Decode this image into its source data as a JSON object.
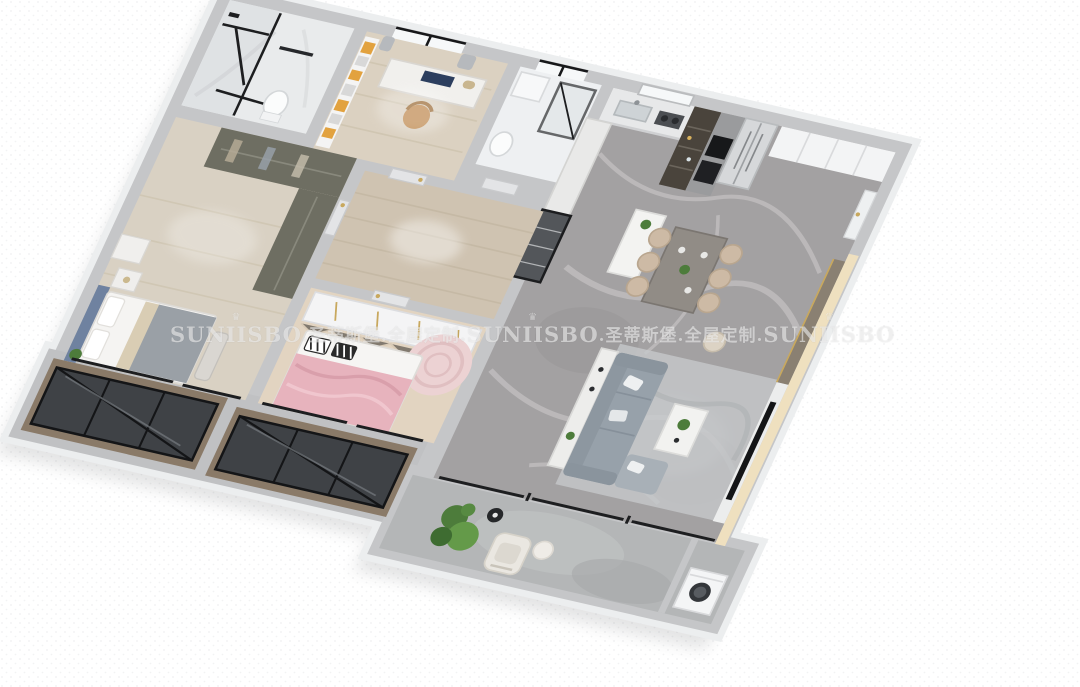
{
  "scene": {
    "description": "3D isometric dollhouse render of a furnished three-bedroom apartment, rotated on a white dotted background",
    "rooms_depicted": [
      "bathroom",
      "study",
      "second-bathroom",
      "kitchen",
      "dining-area",
      "living-room",
      "master-bedroom",
      "kids-bedroom",
      "hallway",
      "bay-windows",
      "balcony",
      "laundry-corner"
    ]
  },
  "watermark": {
    "brand": "SUNIISBO",
    "cn_segment": ".圣蒂斯堡.全屋定制.",
    "crown_glyph": "♛",
    "color": "rgba(252,252,252,0.55)",
    "repeats": 3
  },
  "palette": {
    "background": "#ffffff",
    "dot_texture": "#e2e3e5",
    "wall_grey": "#c5c6c8",
    "slab_edge": "#f1f2f3",
    "marble_floor": "#a3a1a2",
    "wood_floor": "#d8cdbb",
    "herringbone_wood": "#e2d4c1",
    "accent_orange": "#e2a23f",
    "headboard_blue": "#6f82a0",
    "kids_pink": "#e7b3bd",
    "sofa_grey": "#97a1aa",
    "plant_green": "#4d7c3b",
    "warm_light": "#f1e2bf",
    "frame_black": "#17181a",
    "taupe_panel": "#8a8072",
    "gold_trim": "#c8a85e",
    "bay_taupe": "#8a7a68",
    "balcony_grey": "#b4b6b7"
  }
}
